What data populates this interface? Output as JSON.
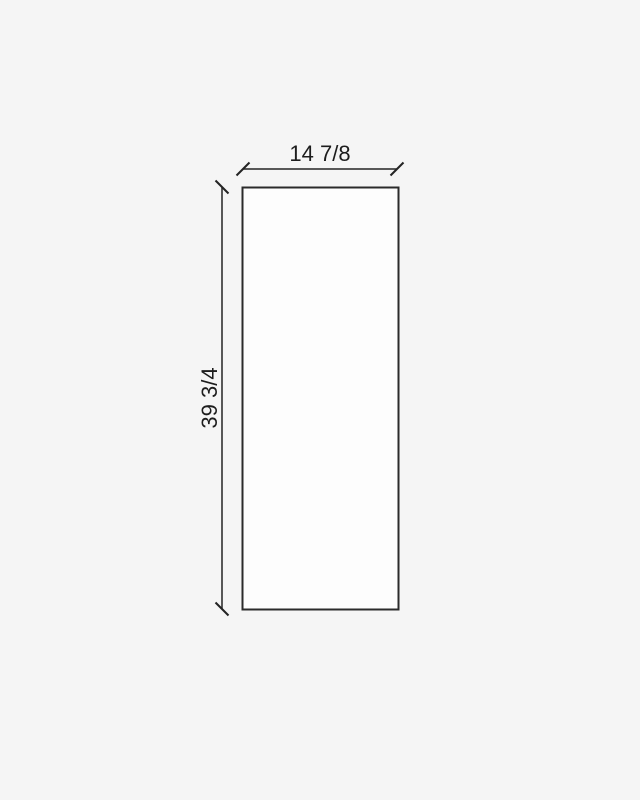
{
  "drawing": {
    "width_dimension": {
      "label": "14 7/8"
    },
    "height_dimension": {
      "label": "39 3/4"
    },
    "colors": {
      "background": "#f5f5f5",
      "panel_fill": "#fdfdfd",
      "line": "#2b2b2b",
      "text": "#1d1d1d"
    }
  }
}
